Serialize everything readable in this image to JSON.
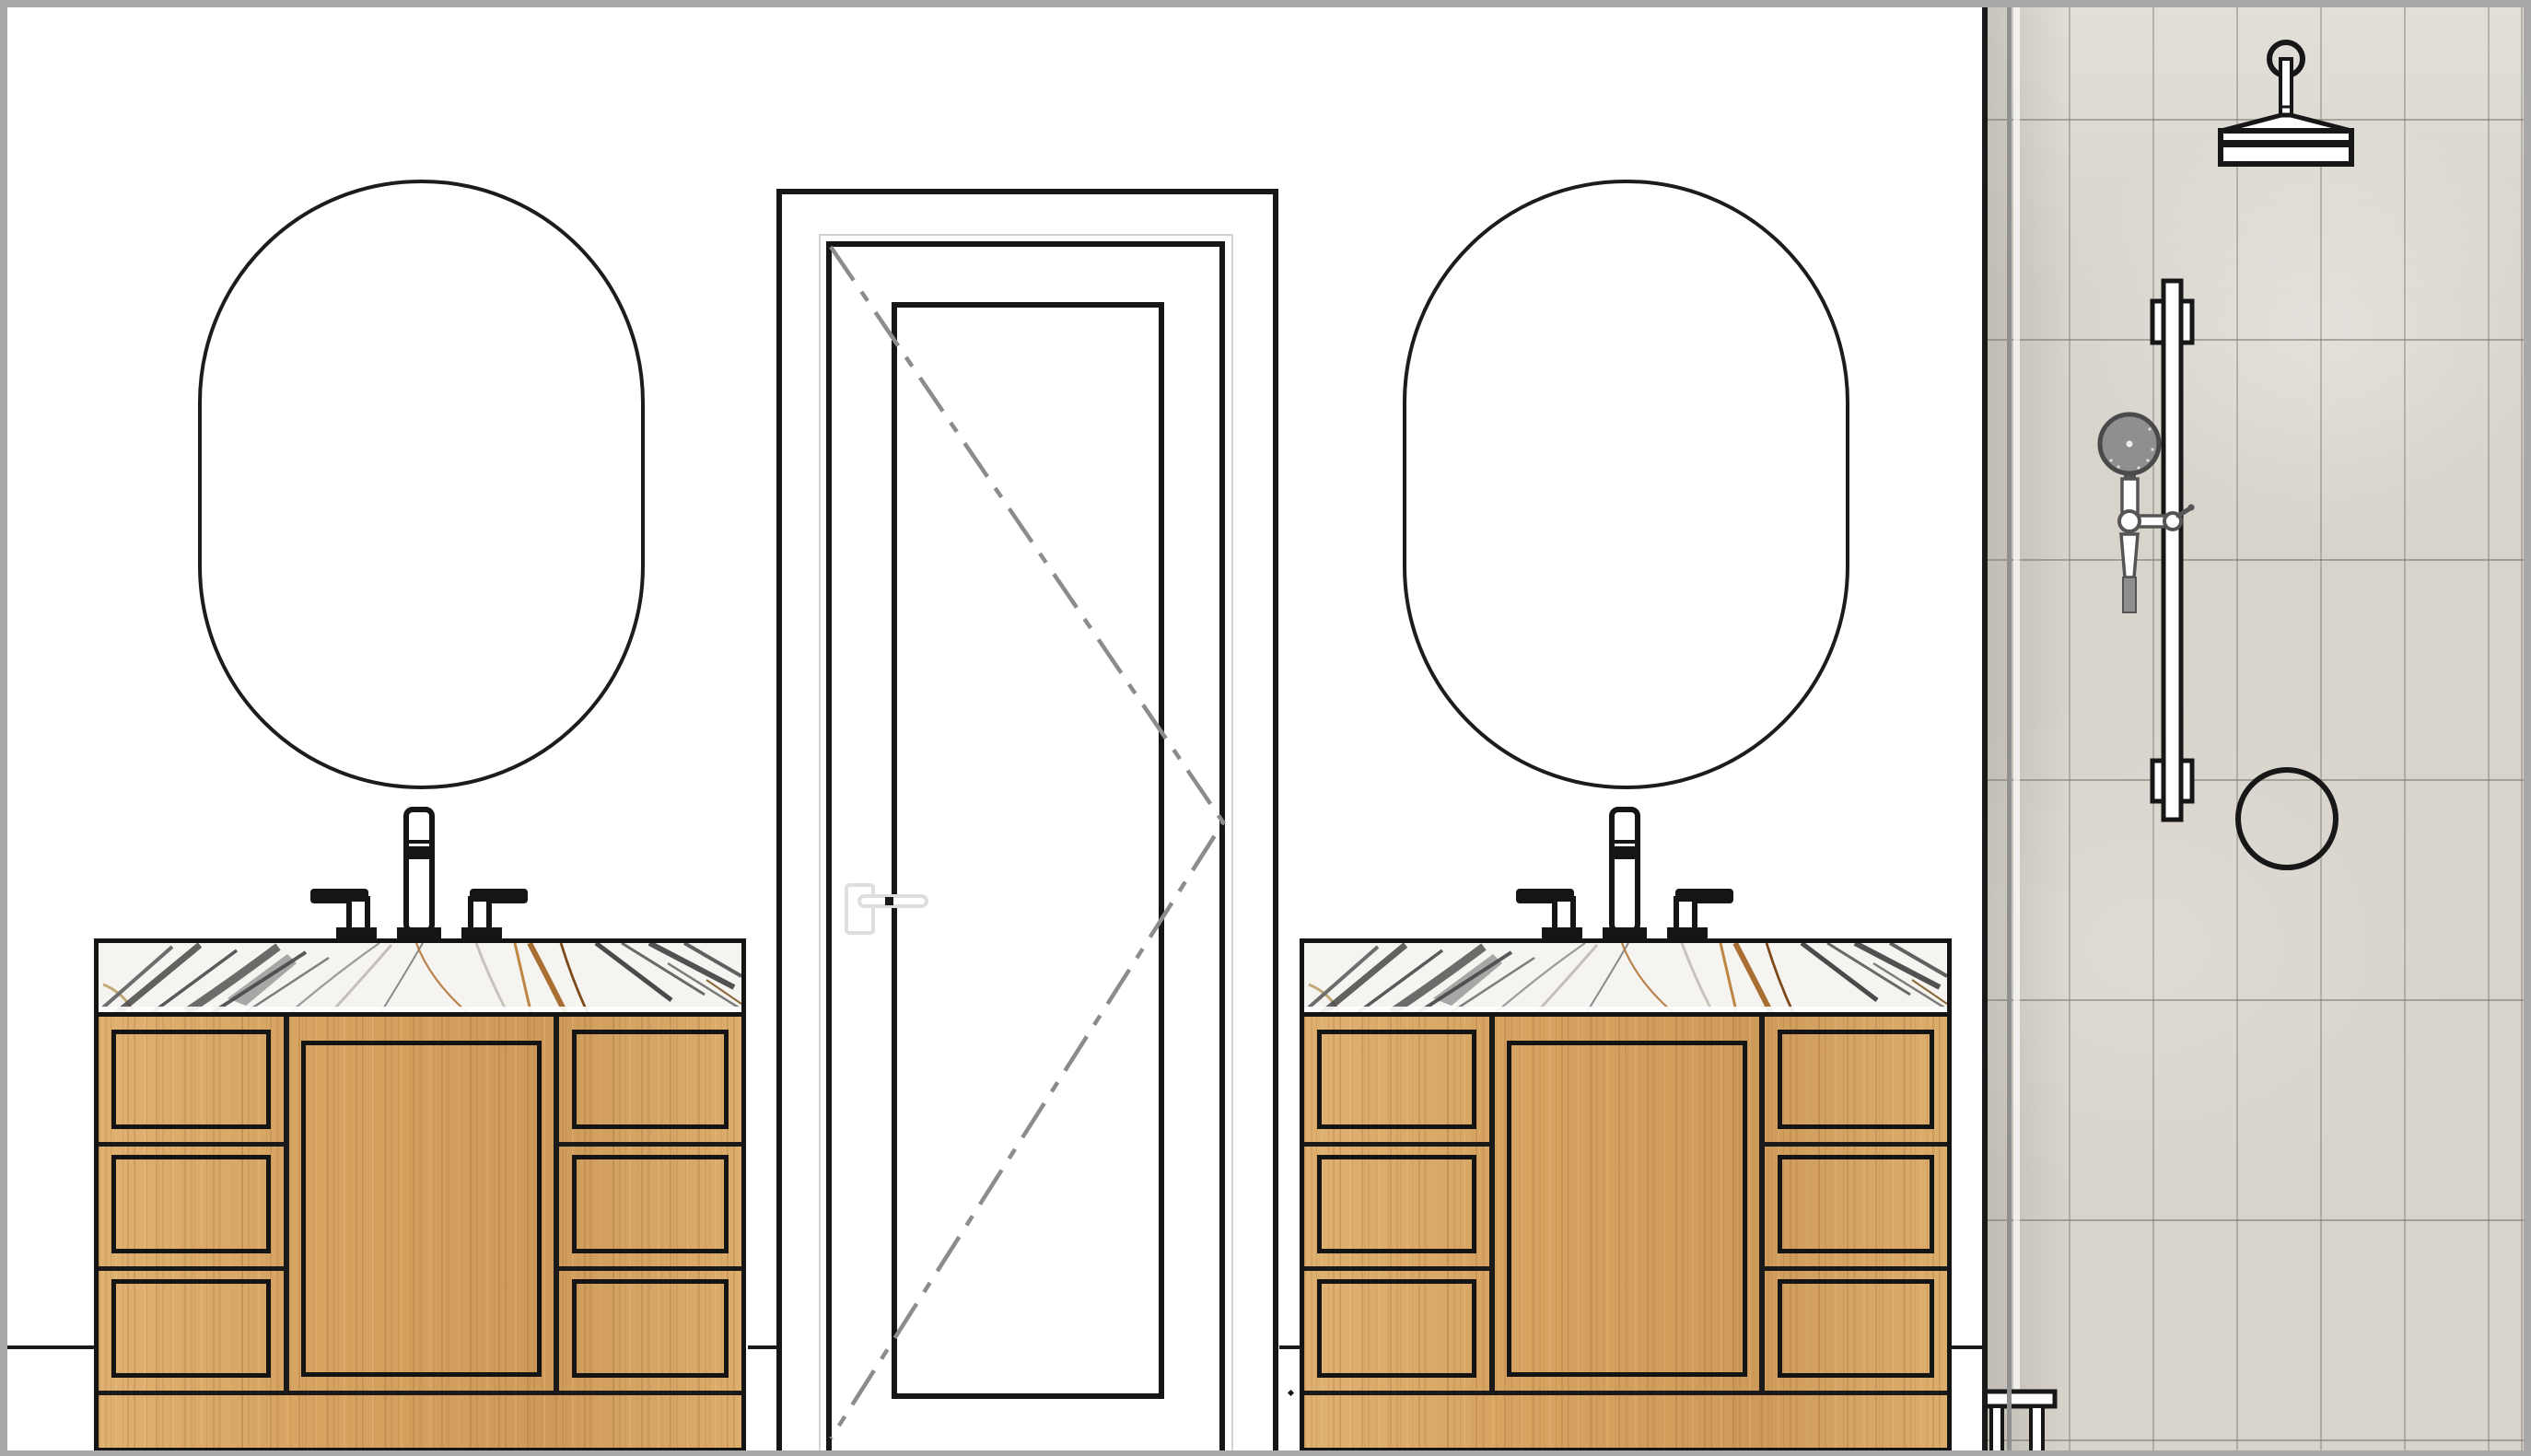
{
  "drawing": {
    "kind": "bathroom-interior-elevation",
    "regions": {
      "left_vanity": "double-drawer wood vanity with marble top and widespread faucet",
      "right_vanity": "double-drawer wood vanity with marble top and widespread faucet",
      "door": "single swing door with recessed panel and dashed swing lines",
      "shower": "tiled shower wall with rain head, slide bar, hand shower, valve and stool"
    },
    "colors": {
      "line": "#1a1a1a",
      "wall": "#ffffff",
      "page_border": "#a8a8a8",
      "wood": "#d7a462",
      "marble_base": "#f6f4f0",
      "marble_gray_vein": "#4a4a4a",
      "marble_gold_vein": "#a15f1d",
      "tile": "#d8d4cc",
      "tile_grout": "#aaa69d",
      "fixture_gray": "#8f8f8f",
      "fixture_dark_gray": "#4a4a4a",
      "door_handle_gray": "#dedede",
      "swing_line_gray": "#8c8c8c"
    },
    "icons": [
      "mirror-icon",
      "faucet-icon",
      "door-swing-icon",
      "door-handle-icon",
      "rain-shower-head-icon",
      "hand-shower-icon",
      "slide-bar-icon",
      "shower-valve-icon",
      "stool-icon"
    ]
  }
}
